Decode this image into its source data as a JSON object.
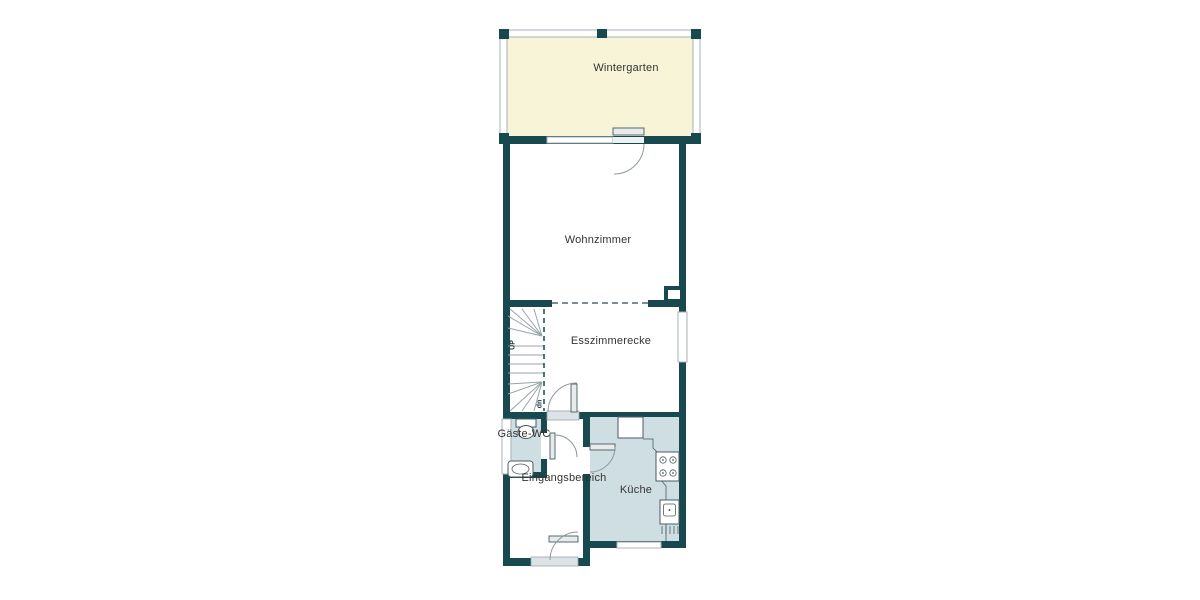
{
  "plan": {
    "type": "floor-plan",
    "rooms": {
      "wintergarten": {
        "label": "Wintergarten"
      },
      "wohnzimmer": {
        "label": "Wohnzimmer"
      },
      "esszimmerecke": {
        "label": "Esszimmerecke"
      },
      "gaeste_wc": {
        "label": "Gäste-WC"
      },
      "eingangsbereich": {
        "label": "Eingangsbereich"
      },
      "kueche": {
        "label": "Küche"
      }
    },
    "stairs": {
      "up_label": "UP",
      "down_label": "dn"
    }
  },
  "palette": {
    "wall": "#17494f",
    "wintergarten_fill": "#f7f4d8",
    "wet_room_fill": "#cfdee3",
    "glass_frame": "#a6b2b8",
    "fixture_outline": "#4a5b60",
    "tread": "#98a3a8",
    "label_color": "#333333"
  }
}
